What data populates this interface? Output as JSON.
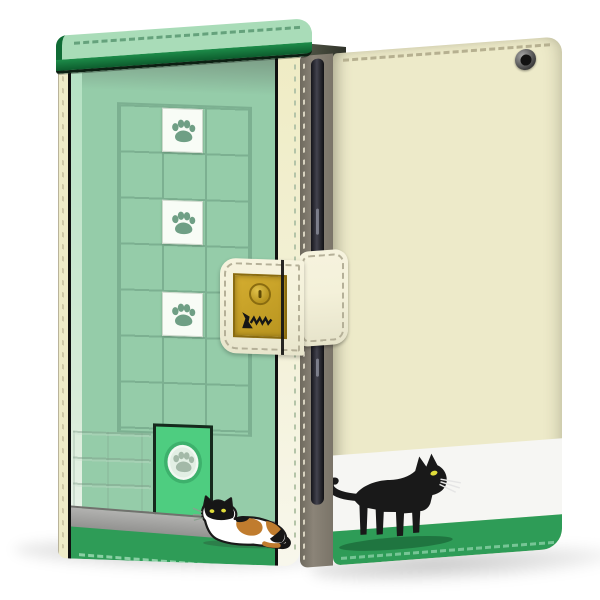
{
  "palette": {
    "bg": "#ffffff",
    "roof-green": "#a9dcb8",
    "roof-trim": "#157f40",
    "wall-green": "#95cca9",
    "wall-shadow": "#76937e",
    "grid-line": "#7cb091",
    "pillar-green": "#b4e1c3",
    "tile-white": "#f8fcf6",
    "paw-green": "#6f9f85",
    "door-green": "#4ecd80",
    "door-ring": "#3db16c",
    "floor-gray": "#9f9f9d",
    "band-green": "#2e9c57",
    "cream": "#efecc9",
    "strap-cream": "#f4f1da",
    "stitch-gray": "#b5b098",
    "buckle-gold": "#c8a42a",
    "buckle-border": "#8a6c10",
    "spine-gray": "#8b8478",
    "phone-dark": "#1d1d24",
    "back-cream": "#edeac9",
    "white-band": "#f6f6f3",
    "cat-black": "#191919",
    "cat-eye": "#e0dd3a",
    "calico-orange": "#c07c2e",
    "shadow": "rgba(0,0,0,0.18)"
  },
  "front_case": {
    "view": "front",
    "grid": {
      "columns": 3,
      "rows": 7
    },
    "paw_tiles": [
      {
        "row": 0
      },
      {
        "row": 2
      },
      {
        "row": 4
      }
    ],
    "door_paw_emblems": 1,
    "cat": "calico-cat",
    "closure": {
      "strap": 1,
      "gold_buckle": 1,
      "snap_button": 1,
      "cat_doodle": 1
    }
  },
  "back_case": {
    "view": "back",
    "cat": "black-cat",
    "camera_holes": 1,
    "bands": [
      "cream",
      "white",
      "green"
    ]
  },
  "icons": [
    "paw-icon",
    "camera-hole",
    "snap-button",
    "calico-cat",
    "black-cat",
    "cat-doodle"
  ]
}
